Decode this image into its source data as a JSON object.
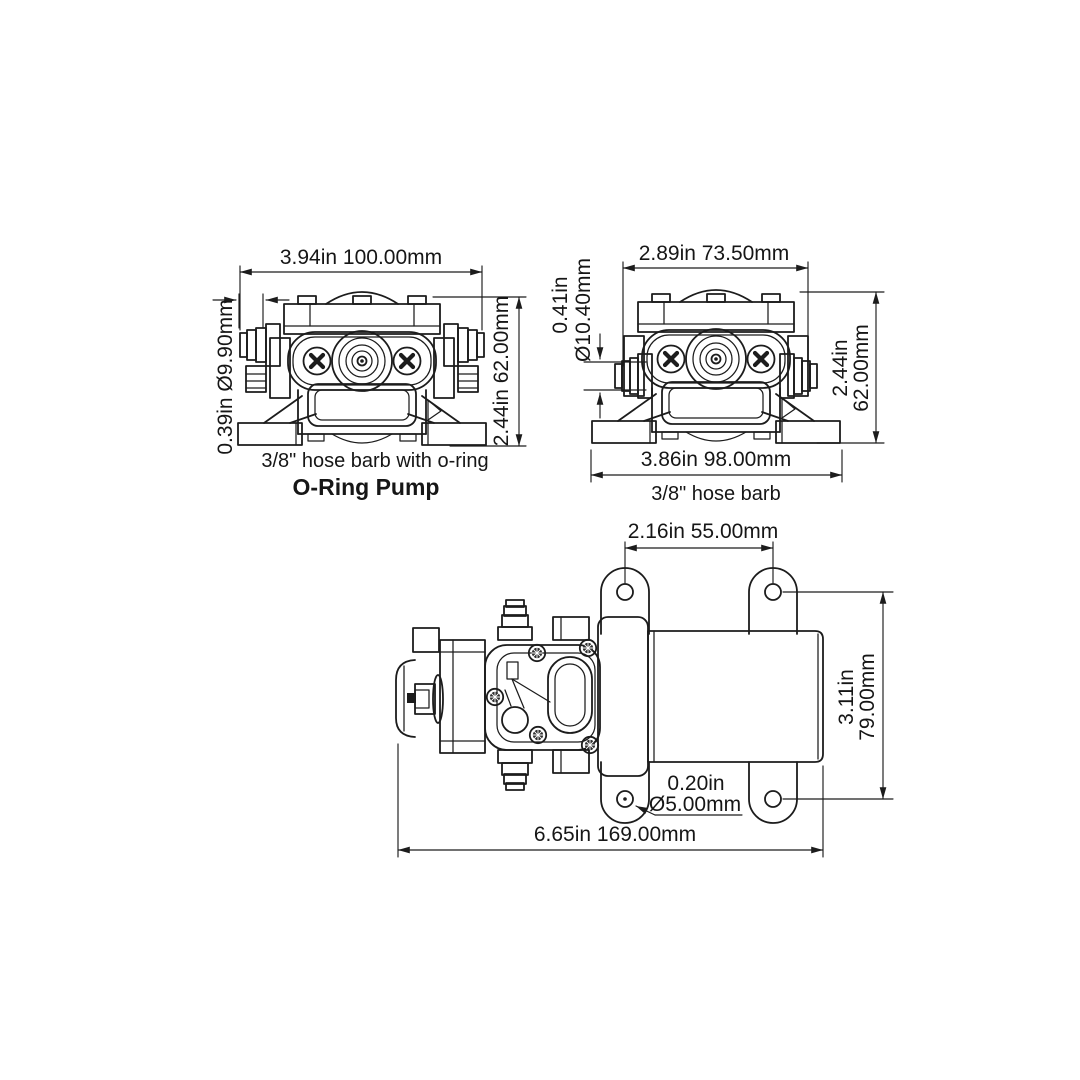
{
  "front_left": {
    "dim_width": "3.94in  100.00mm",
    "dim_barb": "0.39in  Ø9.90mm",
    "dim_height": "2.44in  62.00mm",
    "caption": "3/8\" hose barb with o-ring",
    "title": "O-Ring Pump"
  },
  "front_right": {
    "dim_width": "2.89in 73.50mm",
    "dim_barb_in": "0.41in",
    "dim_barb_mm": "Ø10.40mm",
    "dim_height_in": "2.44in",
    "dim_height_mm": "62.00mm",
    "dim_feet": "3.86in 98.00mm",
    "caption": "3/8\" hose barb"
  },
  "side": {
    "dim_hole_span": "2.16in  55.00mm",
    "dim_height_in": "3.11in",
    "dim_height_mm": "79.00mm",
    "dim_hole_in": "0.20in",
    "dim_hole_mm": "Ø5.00mm",
    "dim_length": "6.65in  169.00mm"
  },
  "colors": {
    "background": "#ffffff",
    "line": "#1c1c1c",
    "text": "#161616"
  }
}
